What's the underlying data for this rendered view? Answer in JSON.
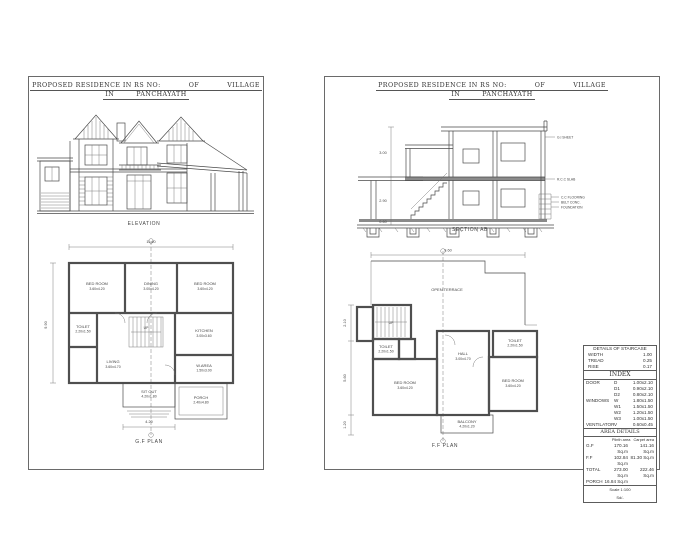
{
  "title": {
    "line1_left": "PROPOSED RESIDENCE IN RS NO:",
    "line1_mid": "OF",
    "line1_right": "VILLAGE",
    "line2_left": "IN",
    "line2_right": "PANCHAYATH"
  },
  "elevation": {
    "label": "ELEVATION"
  },
  "gf_plan": {
    "label": "G.F PLAN",
    "up": "UP",
    "dims": {
      "top": "11.40",
      "left": "9.90",
      "bottom": "4.20"
    },
    "rooms": [
      {
        "name": "BED ROOM",
        "size": "3.60x4.20"
      },
      {
        "name": "DINING",
        "size": "3.00x4.20"
      },
      {
        "name": "BED ROOM",
        "size": "3.60x4.20"
      },
      {
        "name": "TOILET",
        "size": "2.20x1.50"
      },
      {
        "name": "LIVING",
        "size": "3.60x4.70"
      },
      {
        "name": "KITCHEN",
        "size": "3.00x3.60"
      },
      {
        "name": "W.AREA",
        "size": "1.50x3.00"
      },
      {
        "name": "SIT OUT",
        "size": "4.20x1.80"
      },
      {
        "name": "PORCH",
        "size": "2.40x4.80"
      }
    ]
  },
  "section": {
    "label": "SECTION AB",
    "dims": {
      "d1": "3.00",
      "d2": "2.90",
      "d3": "0.60"
    },
    "notes": [
      "G.I SHEET",
      "R.C.C SLAB",
      "C.C FLOORING",
      "BELT CONC.",
      "FOUNDATION"
    ]
  },
  "ff_plan": {
    "label": "F.F PLAN",
    "up": "UP",
    "dims": {
      "top": "9.60",
      "d1": "2.10",
      "d2": "5.60",
      "d3": "1.20"
    },
    "rooms": [
      {
        "name": "OPEN TERRACE",
        "size": ""
      },
      {
        "name": "TOILET",
        "size": "2.20x1.50"
      },
      {
        "name": "BED ROOM",
        "size": "3.60x4.20"
      },
      {
        "name": "HALL",
        "size": "3.00x4.70"
      },
      {
        "name": "TOILET",
        "size": "2.20x1.50"
      },
      {
        "name": "BED ROOM",
        "size": "3.60x4.20"
      },
      {
        "name": "BALCONY",
        "size": "4.20x1.20"
      }
    ]
  },
  "index_table": {
    "staircase": {
      "title": "DETAILS OF STAIRCASE",
      "rows": [
        [
          "WIDTH",
          "1.00"
        ],
        [
          "TREAD",
          "0.25"
        ],
        [
          "RISE",
          "0.17"
        ]
      ]
    },
    "index": {
      "title": "INDEX",
      "groups": [
        {
          "label": "DOOR",
          "items": [
            [
              "D",
              "1.00x2.10"
            ],
            [
              "D1",
              "0.90x2.10"
            ],
            [
              "D2",
              "0.80x2.10"
            ]
          ]
        },
        {
          "label": "WINDOWS",
          "items": [
            [
              "W",
              "1.80x1.50"
            ],
            [
              "W1",
              "1.50x1.50"
            ],
            [
              "W2",
              "1.20x1.50"
            ],
            [
              "W3",
              "1.00x1.50"
            ]
          ]
        },
        {
          "label": "VENTILATOR",
          "items": [
            [
              "V",
              "0.60x0.45"
            ]
          ]
        }
      ]
    },
    "area": {
      "title": "AREA DETAILS",
      "col1": "Plinth area",
      "col2": "Carpet area",
      "rows": [
        [
          "G.F",
          "170.16 Sq.m",
          "141.16 Sq.m"
        ],
        [
          "F.F",
          "102.84 Sq.m",
          "81.30 Sq.m"
        ],
        [
          "TOTAL",
          "273.00 Sq.m",
          "222.46 Sq.m"
        ],
        [
          "PORCH",
          "16.84 Sq.m",
          ""
        ]
      ]
    },
    "footer1": "Scale 1:100",
    "footer2": "Sd/-"
  }
}
